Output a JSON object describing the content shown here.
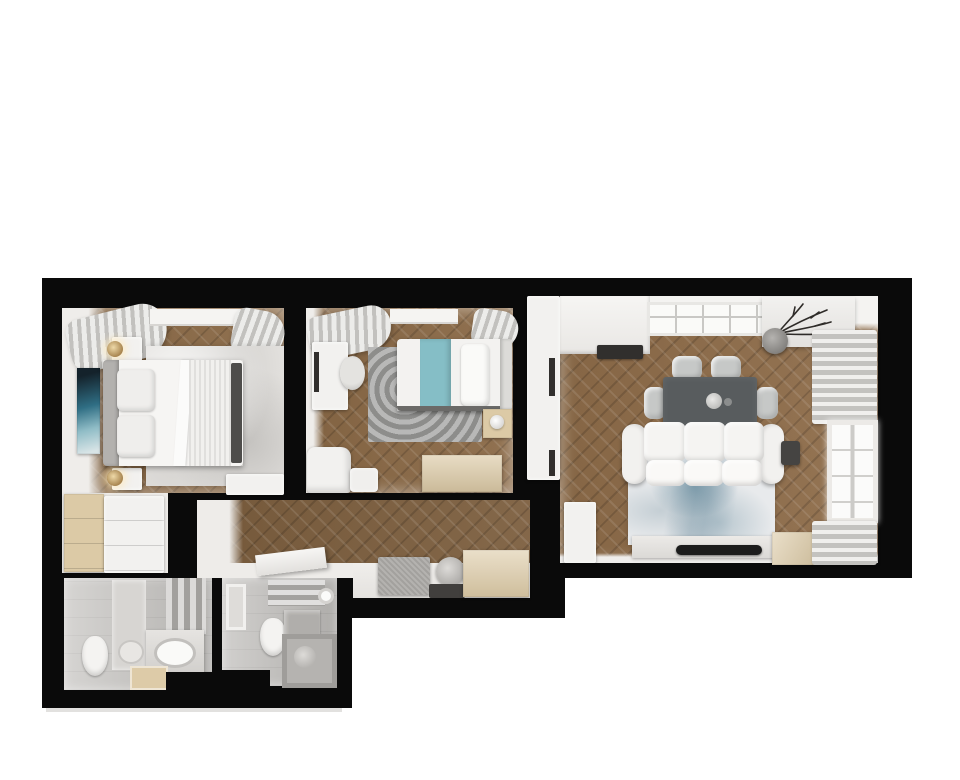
{
  "scene": {
    "title": "Top-down 3D render of a two-bedroom apartment floor plan",
    "view": "orthographic top view, furnished, black wall silhouette on white background"
  },
  "palette": {
    "background": "#ffffff",
    "wall": "#0a0a0a",
    "woodBedroom": "#8a6946",
    "woodLiving": "#8e6c49",
    "woodHallway": "#7c5e3e",
    "whiteFurniture": "#f2f1ef",
    "whiteWallFace": "#eeece9",
    "sofaWhite": "#f4f3f1",
    "headboardGray": "#b3b1ae",
    "beigeWood": "#dccaa6",
    "tealBlanket": "#85bec6",
    "artworkTeal": "#2f6e84",
    "diningTableGray": "#585c5e",
    "chairGray": "#c6c8c7",
    "rugBedroom1": "#e3e1de",
    "rugBedroom2": "#9d9d9b",
    "rugLivingBase": "#e8eaec",
    "tvBlack": "#1c1c1c",
    "bathTile1": "#c8c6c3",
    "bathTile2": "#c2c0bd",
    "mirrorGray": "#d7d5d2",
    "benchGray": "#a3a19e",
    "matDark": "#413f3d",
    "cooktopDark": "#312f2d",
    "darkAccent": "#4e4d4b",
    "lampGold": "#c9a96d",
    "glassBright": "#fafaf8",
    "tubGray": "#b5b3b0",
    "planShadow": "#e2e1df"
  },
  "rooms": [
    {
      "id": "bedroom-1",
      "name": "Master bedroom",
      "furniture": [
        "double-bed",
        "headboard",
        "pillows",
        "ribbed-duvet",
        "nightstand-top",
        "nightstand-bottom",
        "table-lamps",
        "wall-art",
        "area-rug",
        "window-curtains",
        "low-cabinet",
        "wardrobe"
      ]
    },
    {
      "id": "bedroom-2",
      "name": "Second bedroom",
      "furniture": [
        "single-bed",
        "teal-runner",
        "desk",
        "desk-chair",
        "round-pattern-rug",
        "nightstand",
        "dresser",
        "armchair",
        "window-curtains"
      ]
    },
    {
      "id": "living-room",
      "name": "Living room with kitchenette",
      "furniture": [
        "kitchen-counter",
        "cooktop",
        "tall-wardrobe",
        "dining-table",
        "dining-chairs",
        "sofa",
        "abstract-rug",
        "tv-console",
        "tv",
        "side-table",
        "floor-plant",
        "wall-shelf",
        "curtains",
        "window",
        "wooden-bench",
        "corner-cabinet"
      ]
    },
    {
      "id": "hallway",
      "name": "Hallway / entry",
      "furniture": [
        "angled-shelf",
        "gray-bench",
        "round-mirror",
        "doormat",
        "shoe-cabinet"
      ]
    },
    {
      "id": "bathroom-1",
      "name": "Bathroom with vanity",
      "furniture": [
        "toilet",
        "double-vanity",
        "oval-basin",
        "mirror-panel",
        "shower-panel",
        "floor-mat"
      ]
    },
    {
      "id": "bathroom-2",
      "name": "Bathroom with tub",
      "furniture": [
        "toilet",
        "bathtub",
        "vanity",
        "wall-window",
        "towel-rail"
      ]
    }
  ]
}
